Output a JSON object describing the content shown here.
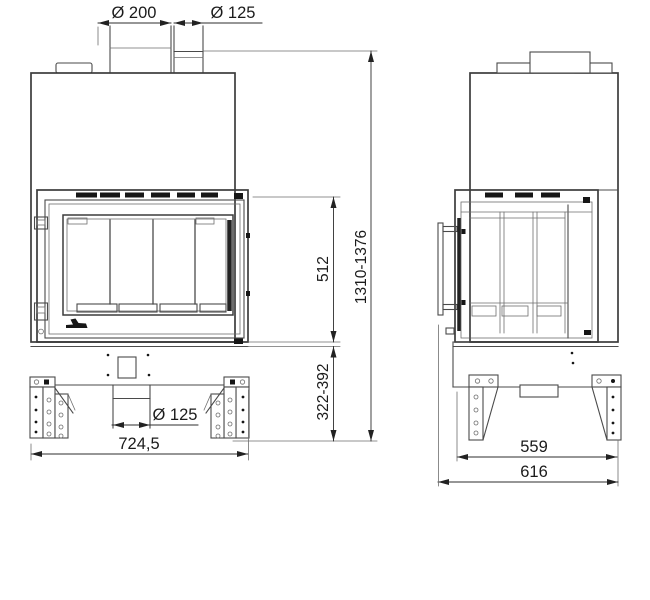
{
  "drawing": {
    "type": "technical-dimension-drawing",
    "subject": "fireplace-insert-front-and-side-views",
    "colors": {
      "background": "#ffffff",
      "outline": "#3c3c3c",
      "thin_line": "#6e6e6e",
      "dimension_line": "#2e2e2e",
      "text": "#1b1b1b",
      "dark_fill": "#161616"
    },
    "dimensions": {
      "top_flue_diameter": "Ø 200",
      "top_pipe_diameter": "Ø 125",
      "firebox_height": "512",
      "overall_height_range": "1310-1376",
      "base_height_range": "322-392",
      "front_width": "724,5",
      "bottom_duct_diameter": "Ø 125",
      "side_depth_inner": "559",
      "side_depth_overall": "616"
    }
  }
}
